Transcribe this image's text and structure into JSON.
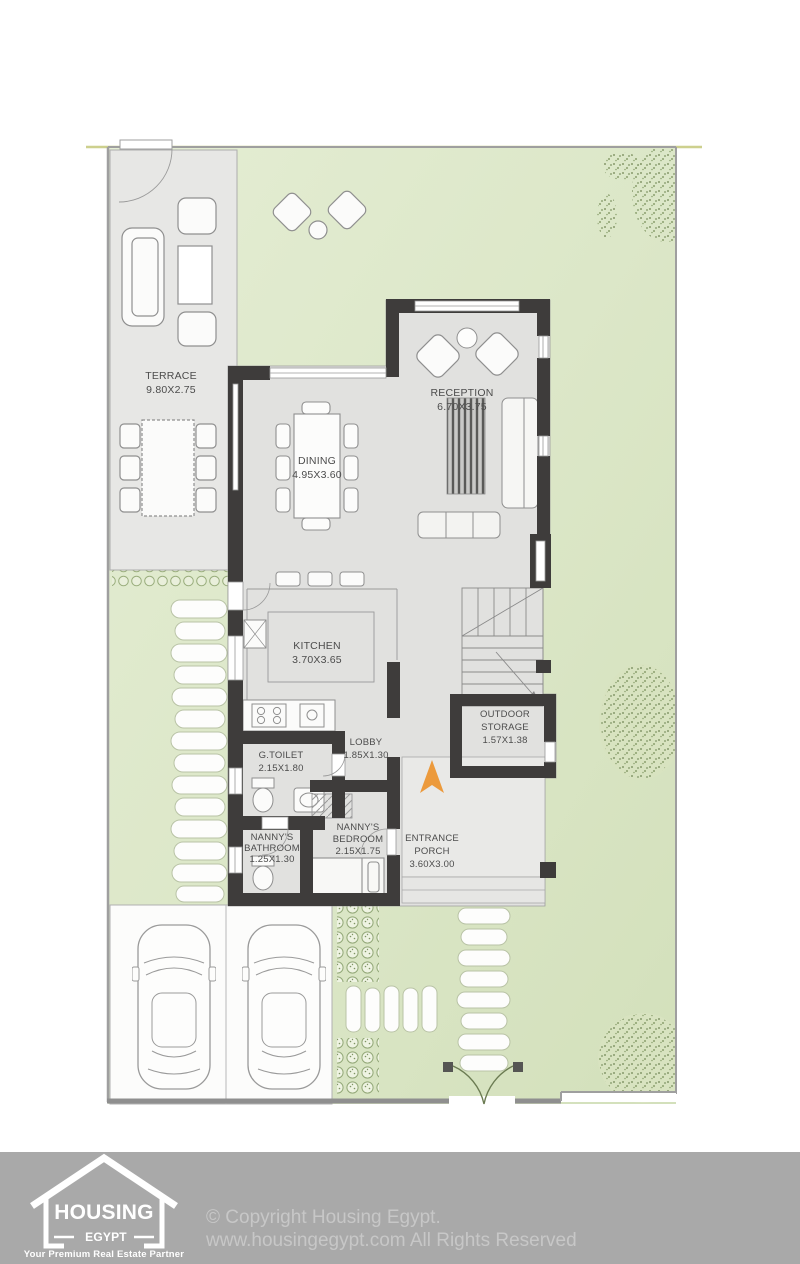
{
  "plan": {
    "rooms": {
      "terrace": {
        "name": "TERRACE",
        "dims": "9.80X2.75"
      },
      "dining": {
        "name": "DINING",
        "dims": "4.95X3.60"
      },
      "reception": {
        "name": "RECEPTION",
        "dims": "6.70X3.75"
      },
      "kitchen": {
        "name": "KITCHEN",
        "dims": "3.70X3.65"
      },
      "lobby": {
        "name": "LOBBY",
        "dims": "1.85X1.30"
      },
      "g_toilet": {
        "name": "G.TOILET",
        "dims": "2.15X1.80"
      },
      "nannys_bathroom": {
        "line1": "NANNY'S",
        "line2": "BATHROOM",
        "dims": "1.25X1.30"
      },
      "nannys_bedroom": {
        "line1": "NANNY'S",
        "line2": "BEDROOM",
        "dims": "2.15X1.75"
      },
      "entrance_porch": {
        "line1": "ENTRANCE",
        "line2": "PORCH",
        "dims": "3.60X3.00"
      },
      "outdoor_storage": {
        "line1": "OUTDOOR",
        "line2": "STORAGE",
        "dims": "1.57X1.38"
      }
    },
    "colors": {
      "garden_green": "#dce7c8",
      "floor_gray": "#e1e1df",
      "wall_dark": "#3e3c3b",
      "accent_orange": "#ec9a3c",
      "footer_gray": "#a9a9a9"
    }
  },
  "footer": {
    "logo_title": "HOUSING",
    "logo_subtitle": "EGYPT",
    "logo_tagline": "Your Premium Real Estate Partner",
    "copyright_line1": "© Copyright Housing Egypt.",
    "copyright_line2": "www.housingegypt.com All Rights Reserved"
  }
}
